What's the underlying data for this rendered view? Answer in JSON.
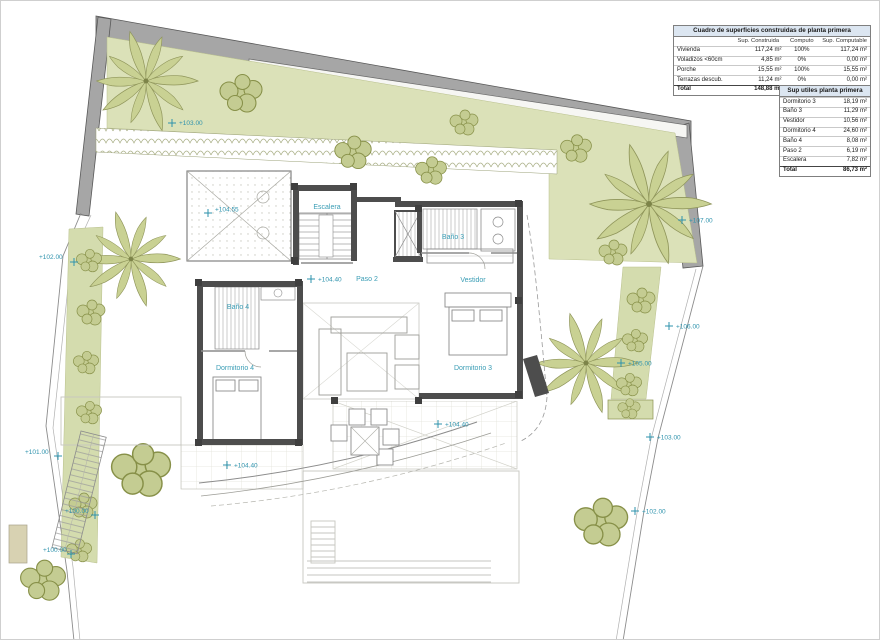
{
  "tables": {
    "construidas": {
      "title": "Cuadro de superficies construidas de planta primera",
      "columns": [
        "",
        "Sup. Construida",
        "Computo",
        "Sup. Computable"
      ],
      "rows": [
        {
          "name": "Vivienda",
          "construida": "117,24 m²",
          "computo": "100%",
          "computable": "117,24 m²"
        },
        {
          "name": "Voladizos <60cm",
          "construida": "4,85 m²",
          "computo": "0%",
          "computable": "0,00 m²"
        },
        {
          "name": "Porche",
          "construida": "15,55 m²",
          "computo": "100%",
          "computable": "15,55 m²"
        },
        {
          "name": "Terrazas descub.",
          "construida": "11,24 m²",
          "computo": "0%",
          "computable": "0,00 m²"
        }
      ],
      "total": {
        "name": "Total",
        "construida": "148,88 m²",
        "computo": "",
        "computable": "132,79 m²"
      }
    },
    "utiles": {
      "title": "Sup utiles planta primera",
      "rows": [
        {
          "name": "Dormitorio 3",
          "value": "18,19 m²"
        },
        {
          "name": "Baño 3",
          "value": "11,29 m²"
        },
        {
          "name": "Vestidor",
          "value": "10,56 m²"
        },
        {
          "name": "Dormitorio 4",
          "value": "24,60 m²"
        },
        {
          "name": "Baño 4",
          "value": "8,08 m²"
        },
        {
          "name": "Paso 2",
          "value": "6,19 m²"
        },
        {
          "name": "Escalera",
          "value": "7,82 m²"
        }
      ],
      "total": {
        "name": "Total",
        "value": "86,73 m²"
      }
    }
  },
  "plan": {
    "rooms": [
      {
        "label": "Escalera"
      },
      {
        "label": "Baño 3"
      },
      {
        "label": "Vestidor"
      },
      {
        "label": "Dormitorio 3"
      },
      {
        "label": "Paso 2"
      },
      {
        "label": "Baño 4"
      },
      {
        "label": "Dormitorio 4"
      }
    ],
    "levels": [
      "+103.00",
      "+107.00",
      "+106.00",
      "+105.00",
      "+103.00",
      "+102.00",
      "+104.55",
      "+104.40",
      "+104.40",
      "+104.40",
      "+102.00",
      "+101.00",
      "+100.00",
      "+100.00"
    ]
  },
  "colors": {
    "garden_green": "#dbe1b8",
    "wall_gray": "#a6a6a6",
    "house_wall": "#4d4d4d",
    "label_teal": "#3a9db5",
    "table_header_blue": "#dce6f1"
  }
}
